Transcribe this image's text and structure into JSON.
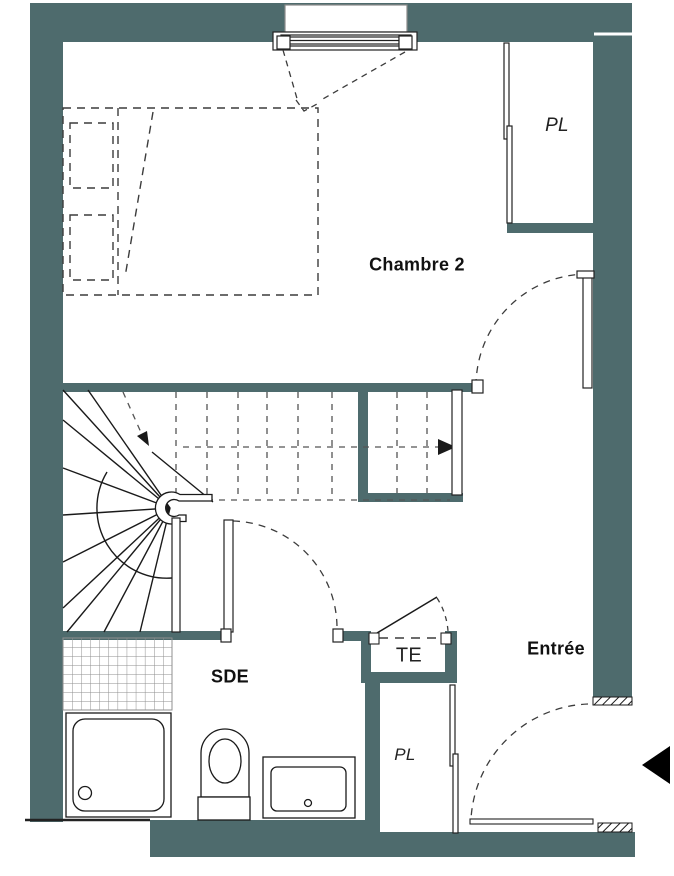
{
  "colors": {
    "wall": "#4e6b6d",
    "line": "#1a1a1a",
    "dash": "#3c3c3c",
    "tile": "#8f8f8f",
    "background": "#ffffff"
  },
  "rooms": {
    "chambre2": {
      "label": "Chambre 2"
    },
    "closet_top": {
      "label": "PL"
    },
    "sde": {
      "label": "SDE"
    },
    "te": {
      "label": "TE"
    },
    "closet_bottom": {
      "label": "PL"
    },
    "entree": {
      "label": "Entrée"
    }
  },
  "fixtures": [
    "window",
    "bed",
    "spiral-staircase",
    "shower",
    "toilet",
    "sink",
    "tiled-floor",
    "entrance-arrow"
  ]
}
